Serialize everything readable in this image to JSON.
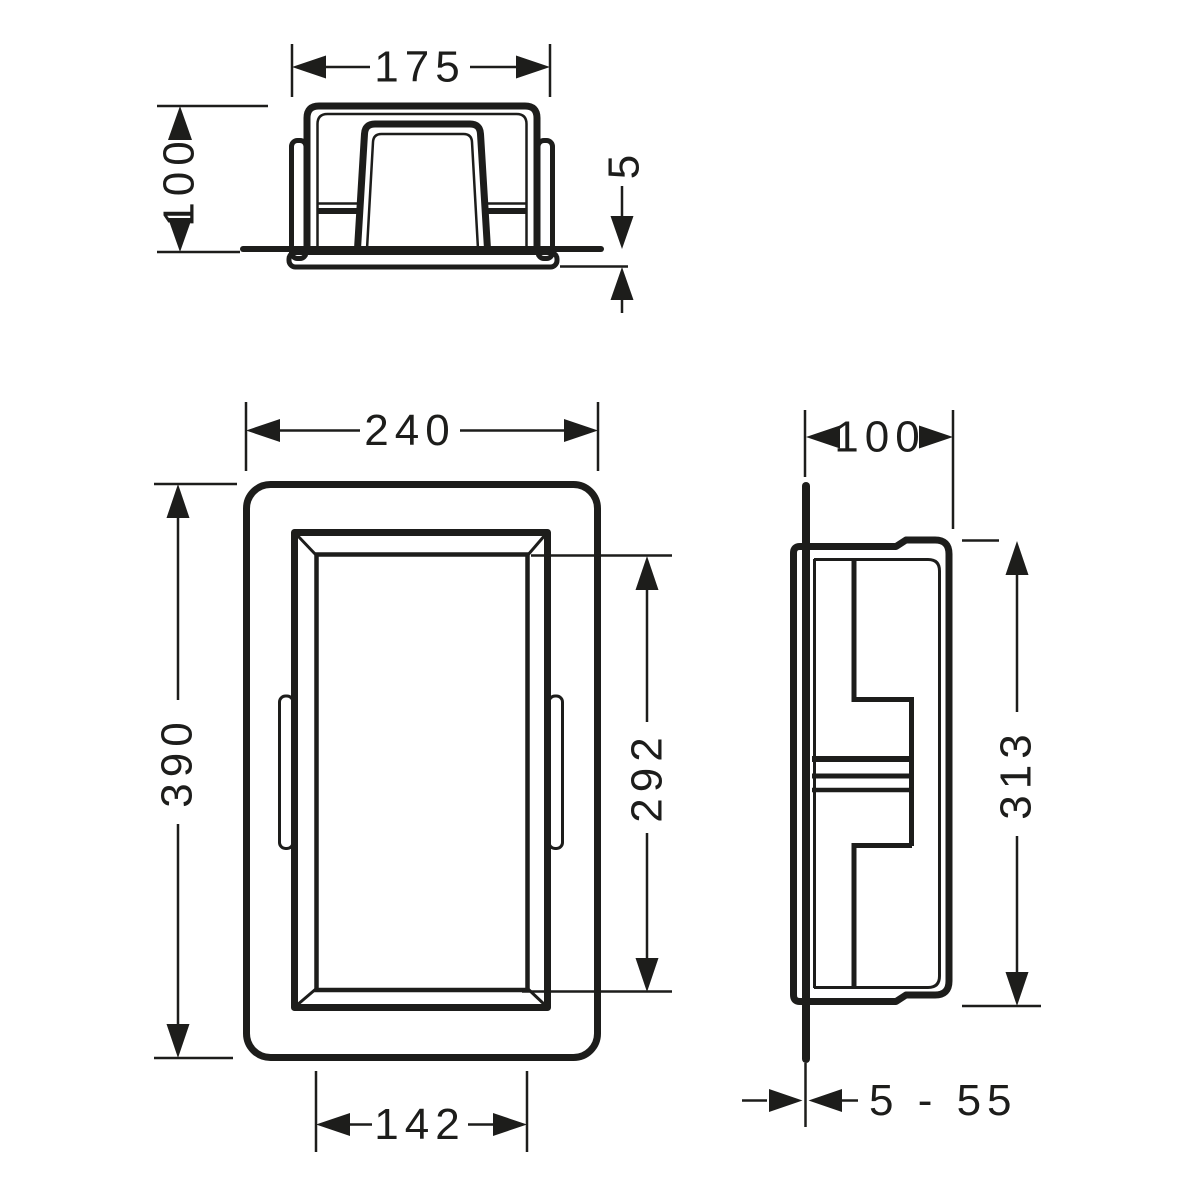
{
  "drawing": {
    "type": "technical-dimension-drawing",
    "colors": {
      "line": "#1d1d1b",
      "background": "#ffffff"
    },
    "views": {
      "top": {
        "label": "top-view",
        "dim_width": "175",
        "dim_depth": "100",
        "dim_flange": "5"
      },
      "front": {
        "label": "front-view",
        "dim_width": "240",
        "dim_height": "390",
        "dim_opening_width": "142",
        "dim_opening_height": "292"
      },
      "side": {
        "label": "side-view",
        "dim_depth": "100",
        "dim_body_height": "313",
        "dim_wall_range": "5 - 55"
      }
    }
  }
}
